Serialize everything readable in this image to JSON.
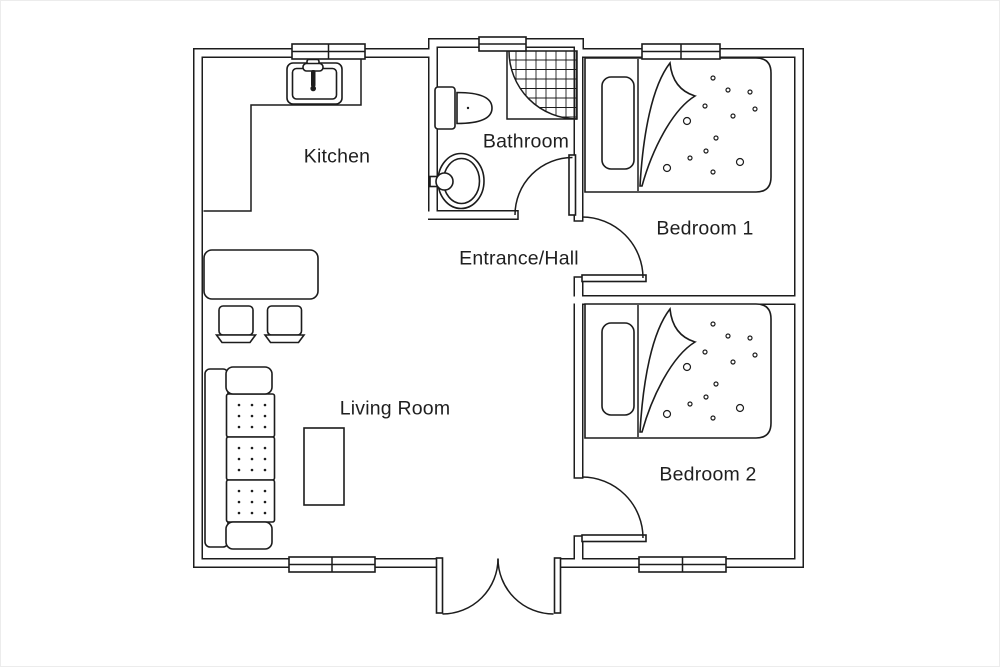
{
  "colors": {
    "line": "#1c1c1c",
    "background": "#ffffff"
  },
  "rooms": {
    "kitchen": {
      "label": "Kitchen"
    },
    "bathroom": {
      "label": "Bathroom"
    },
    "entrance_hall": {
      "label": "Entrance/Hall"
    },
    "bedroom1": {
      "label": "Bedroom 1"
    },
    "bedroom2": {
      "label": "Bedroom 2"
    },
    "living_room": {
      "label": "Living Room"
    }
  },
  "fixtures": [
    "kitchen-sink",
    "kitchen-counter",
    "dining-table",
    "chair",
    "chair",
    "sofa",
    "coffee-table",
    "toilet",
    "wash-basin",
    "corner-shower",
    "single-bed",
    "single-bed",
    "entrance-double-door",
    "bathroom-door",
    "bedroom-1-door",
    "bedroom-2-door",
    "window",
    "window",
    "window",
    "window",
    "window"
  ]
}
